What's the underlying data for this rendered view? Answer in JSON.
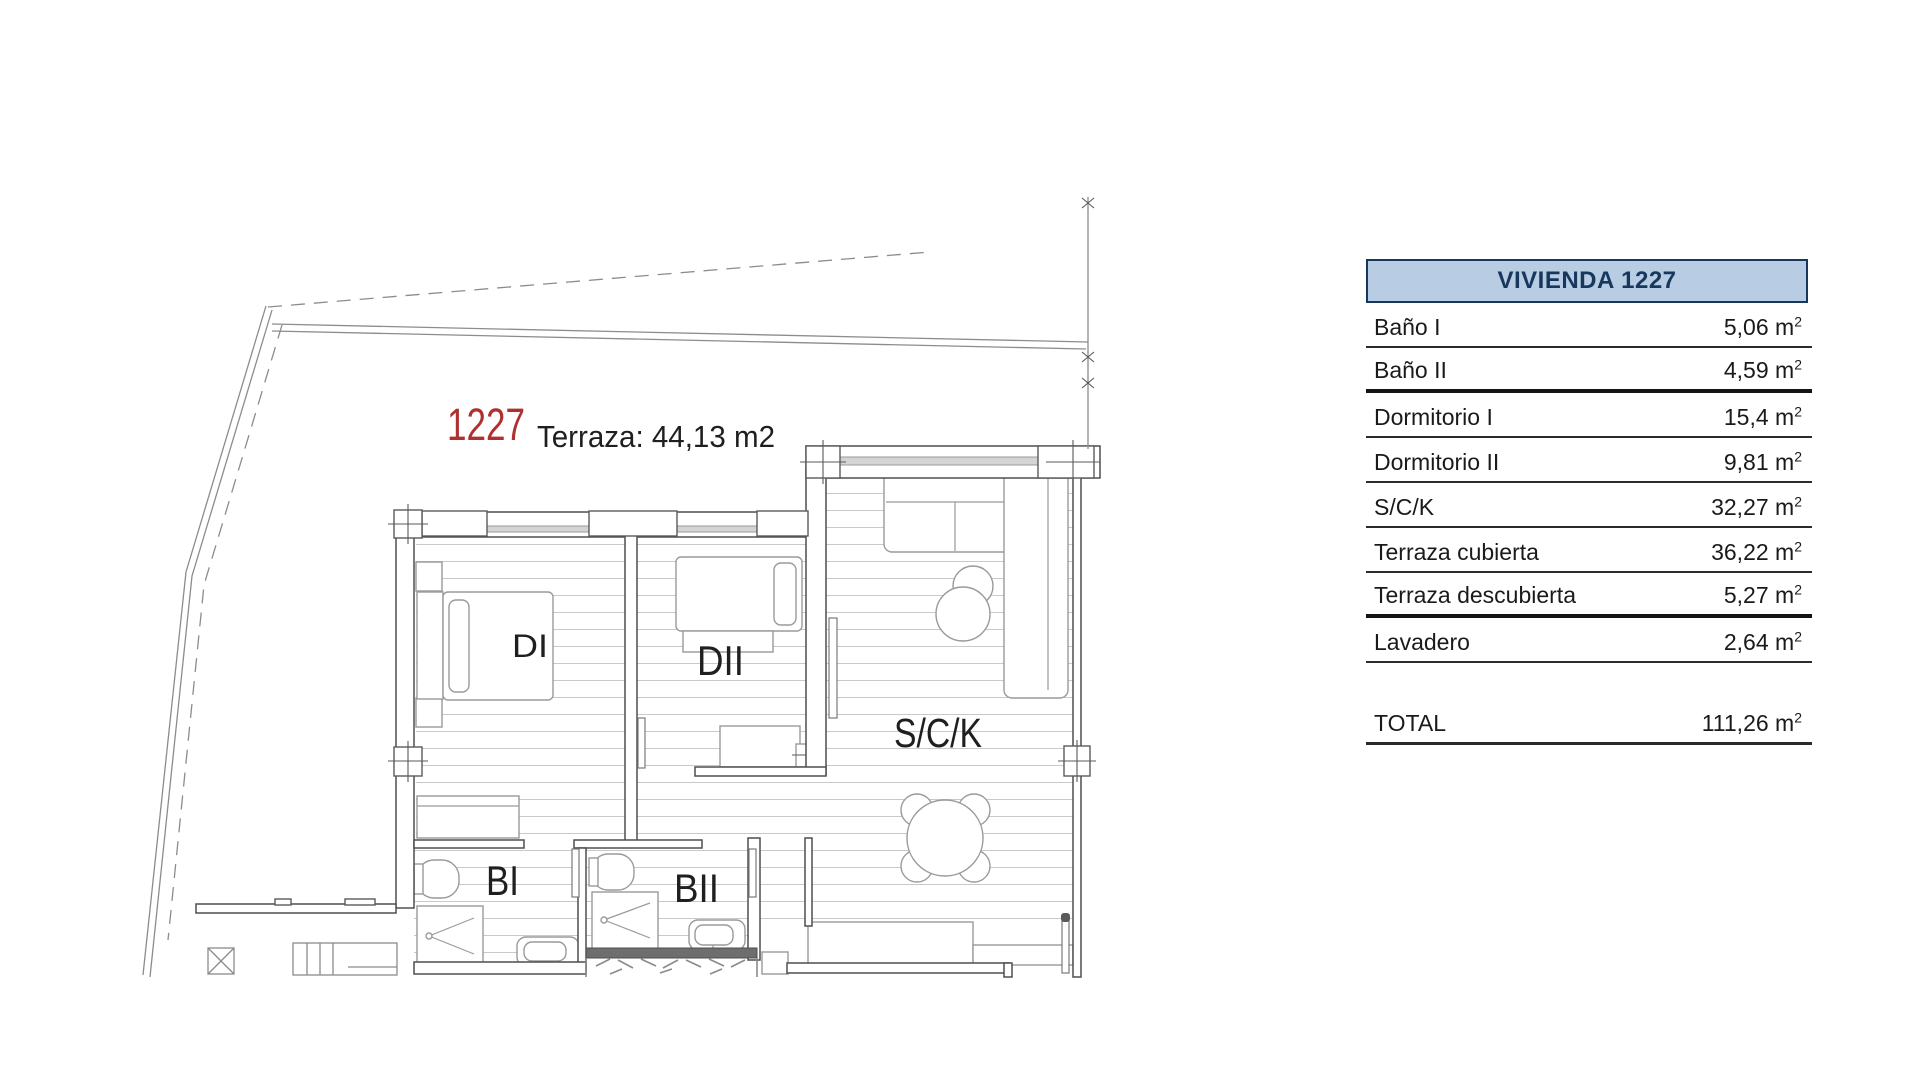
{
  "plan": {
    "unit_number": "1227",
    "terrace_note": "Terraza: 44,13 m2",
    "rooms": {
      "di": "DI",
      "dii": "DII",
      "sck": "S/C/K",
      "bi": "BI",
      "bii": "BII"
    },
    "colors": {
      "unit_number_red": "#b03030",
      "wall_line": "#4f4f4f",
      "hatch_line": "#c9c9c9",
      "boundary_line": "#8c8c8c"
    }
  },
  "table": {
    "title": "VIVIENDA 1227",
    "unit_base": "m",
    "unit_sup": "2",
    "colors": {
      "header_bg": "#b8cce4",
      "header_text": "#17375d",
      "header_border": "#17375d",
      "row_line": "#2b2b2b"
    },
    "rows": [
      {
        "label": "Baño I",
        "value": "5,06",
        "thick": false
      },
      {
        "label": "Baño II",
        "value": "4,59",
        "thick": true
      },
      {
        "label": "Dormitorio I",
        "value": "15,4",
        "thick": false
      },
      {
        "label": "Dormitorio II",
        "value": "9,81",
        "thick": false
      },
      {
        "label": "S/C/K",
        "value": "32,27",
        "thick": false
      },
      {
        "label": "Terraza cubierta",
        "value": "36,22",
        "thick": false
      },
      {
        "label": "Terraza descubierta",
        "value": "5,27",
        "thick": true
      },
      {
        "label": "Lavadero",
        "value": "2,64",
        "thick": false
      }
    ],
    "total": {
      "label": "TOTAL",
      "value": "111,26"
    }
  }
}
